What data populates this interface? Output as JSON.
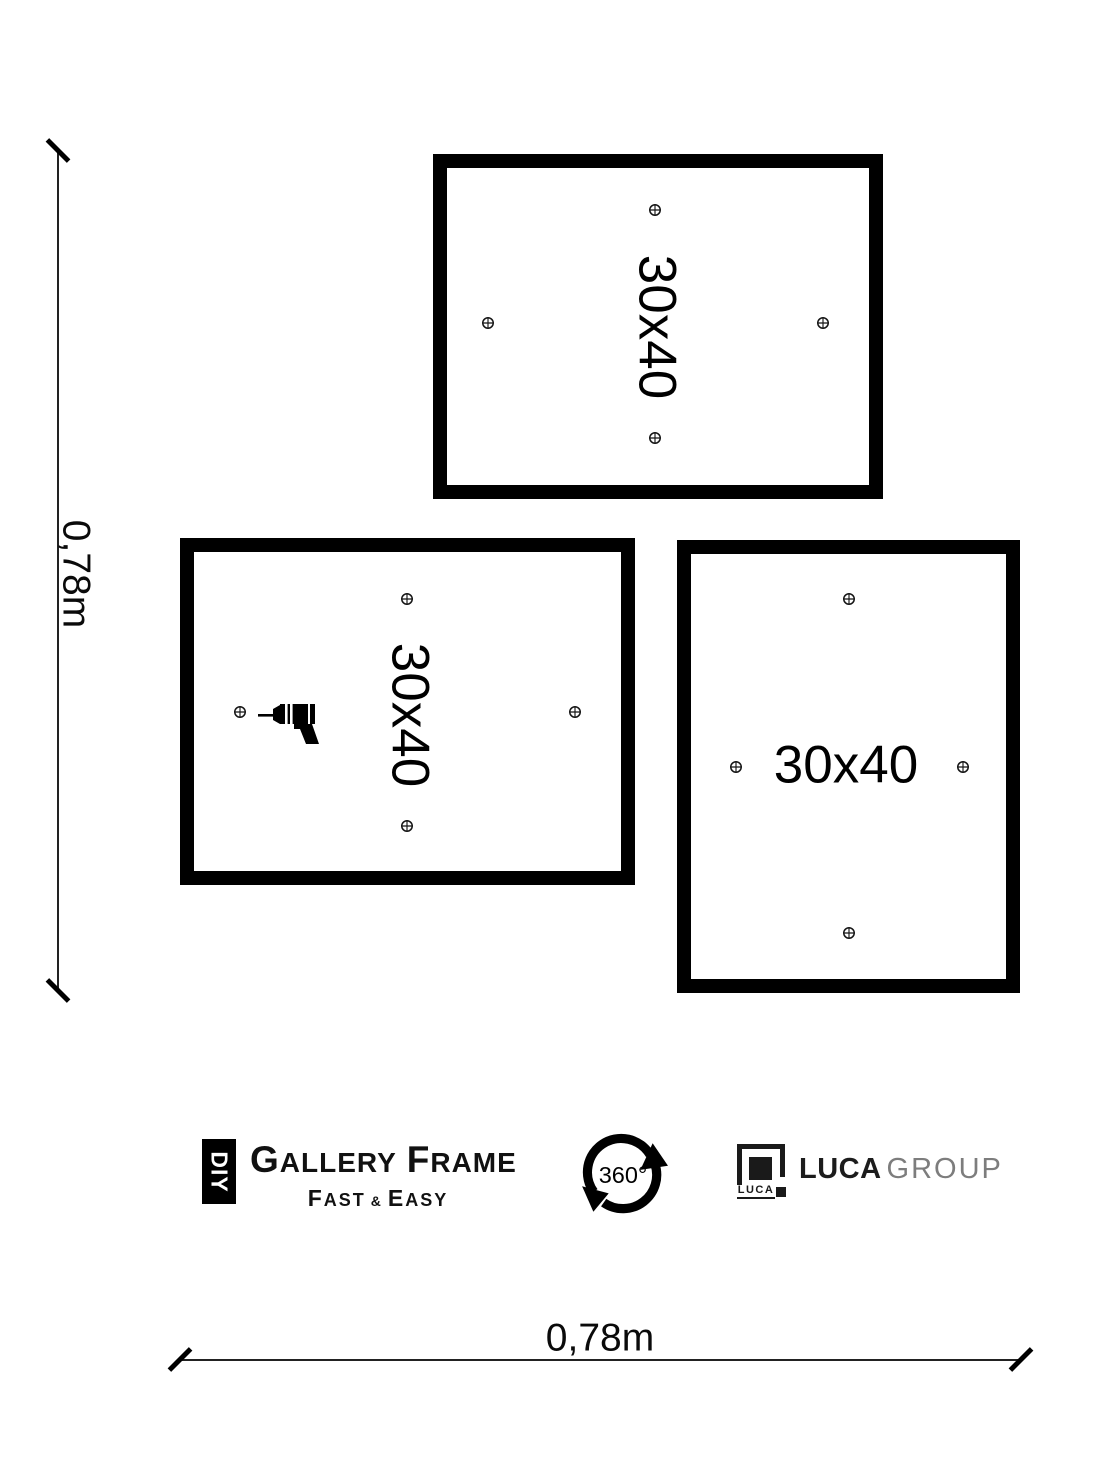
{
  "diagram": {
    "height_dimension": "0,78m",
    "width_dimension": "0,78m",
    "frames": [
      {
        "label": "30x40",
        "orientation": "landscape"
      },
      {
        "label": "30x40",
        "orientation": "landscape"
      },
      {
        "label": "30x40",
        "orientation": "portrait"
      }
    ]
  },
  "branding": {
    "diy": "DIY",
    "gallery_initial": "G",
    "gallery_rest": "ALLERY",
    "frame_initial": "F",
    "frame_rest": "RAME",
    "fast_initial": "F",
    "fast_rest": "AST",
    "ampersand": "&",
    "easy_initial": "E",
    "easy_rest": "ASY",
    "rotation_badge": "360°",
    "luca_icon_label": "LUCA",
    "luca_name": "LUCA",
    "luca_group": "GROUP"
  },
  "colors": {
    "ink": "#000000",
    "luca_group_gray": "#7d7d7d"
  }
}
